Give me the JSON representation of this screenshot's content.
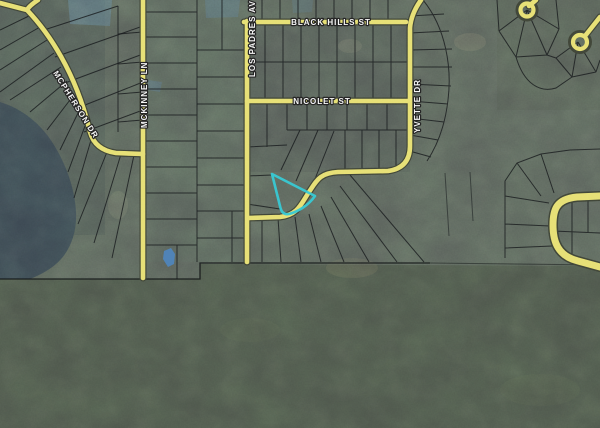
{
  "map": {
    "title": "aerial parcel map",
    "streets": [
      {
        "id": "black-hills",
        "label": "BLACK HILLS ST",
        "orientation": "horizontal"
      },
      {
        "id": "nicolet",
        "label": "NICOLET ST",
        "orientation": "horizontal"
      },
      {
        "id": "los-padres",
        "label": "LOS PADRES AV",
        "orientation": "vertical"
      },
      {
        "id": "yvette",
        "label": "YVETTE DR",
        "orientation": "vertical"
      },
      {
        "id": "mckinney",
        "label": "MCKINNEY LN",
        "orientation": "vertical"
      },
      {
        "id": "mcpherson",
        "label": "MCPHERSON DR",
        "orientation": "diagonal"
      }
    ],
    "colors": {
      "road_fill": "#e6df72",
      "road_casing": "#3f4437",
      "parcel_line": "#16191b",
      "highlight": "#38c9d4",
      "water": "#3c4852",
      "terrain_upper": "#5a615b",
      "terrain_forest": "#4d554b",
      "label_fill": "#f5f5f5",
      "boundary_line": "#101314",
      "pond_marker": "#4f86c0"
    },
    "highlighted_parcel": {
      "description": "selected parcel (cyan outline)",
      "shape": "triangular"
    }
  }
}
